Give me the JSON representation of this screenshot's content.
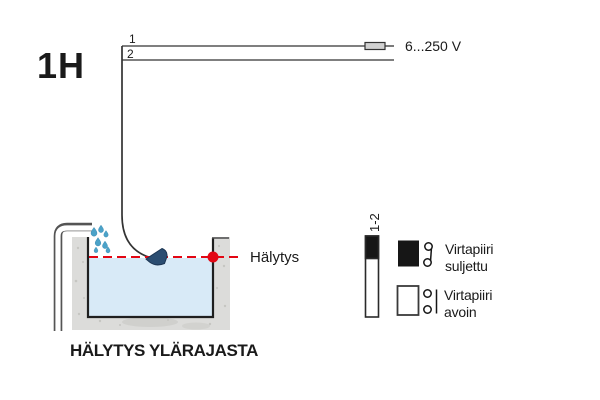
{
  "figure": {
    "id_label": "1H",
    "caption": "HÄLYTYS YLÄRAJASTA"
  },
  "circuit": {
    "wire1_label": "1",
    "wire2_label": "2",
    "voltage_label": "6...250 V"
  },
  "tank": {
    "alarm_label": "Hälytys"
  },
  "legend": {
    "column_label": "1-2",
    "closed": {
      "line1": "Virtapiiri",
      "line2": "suljettu"
    },
    "open": {
      "line1": "Virtapiiri",
      "line2": "avoin"
    }
  },
  "colors": {
    "accent_blue": "#2e5b8d",
    "alarm_red": "#e30613",
    "water_blue": "#d8eaf7",
    "drop_blue": "#4ba2c8",
    "sensor_navy": "#2b4d71",
    "wall_gray": "#dcdcda",
    "contact_black": "#161616"
  }
}
